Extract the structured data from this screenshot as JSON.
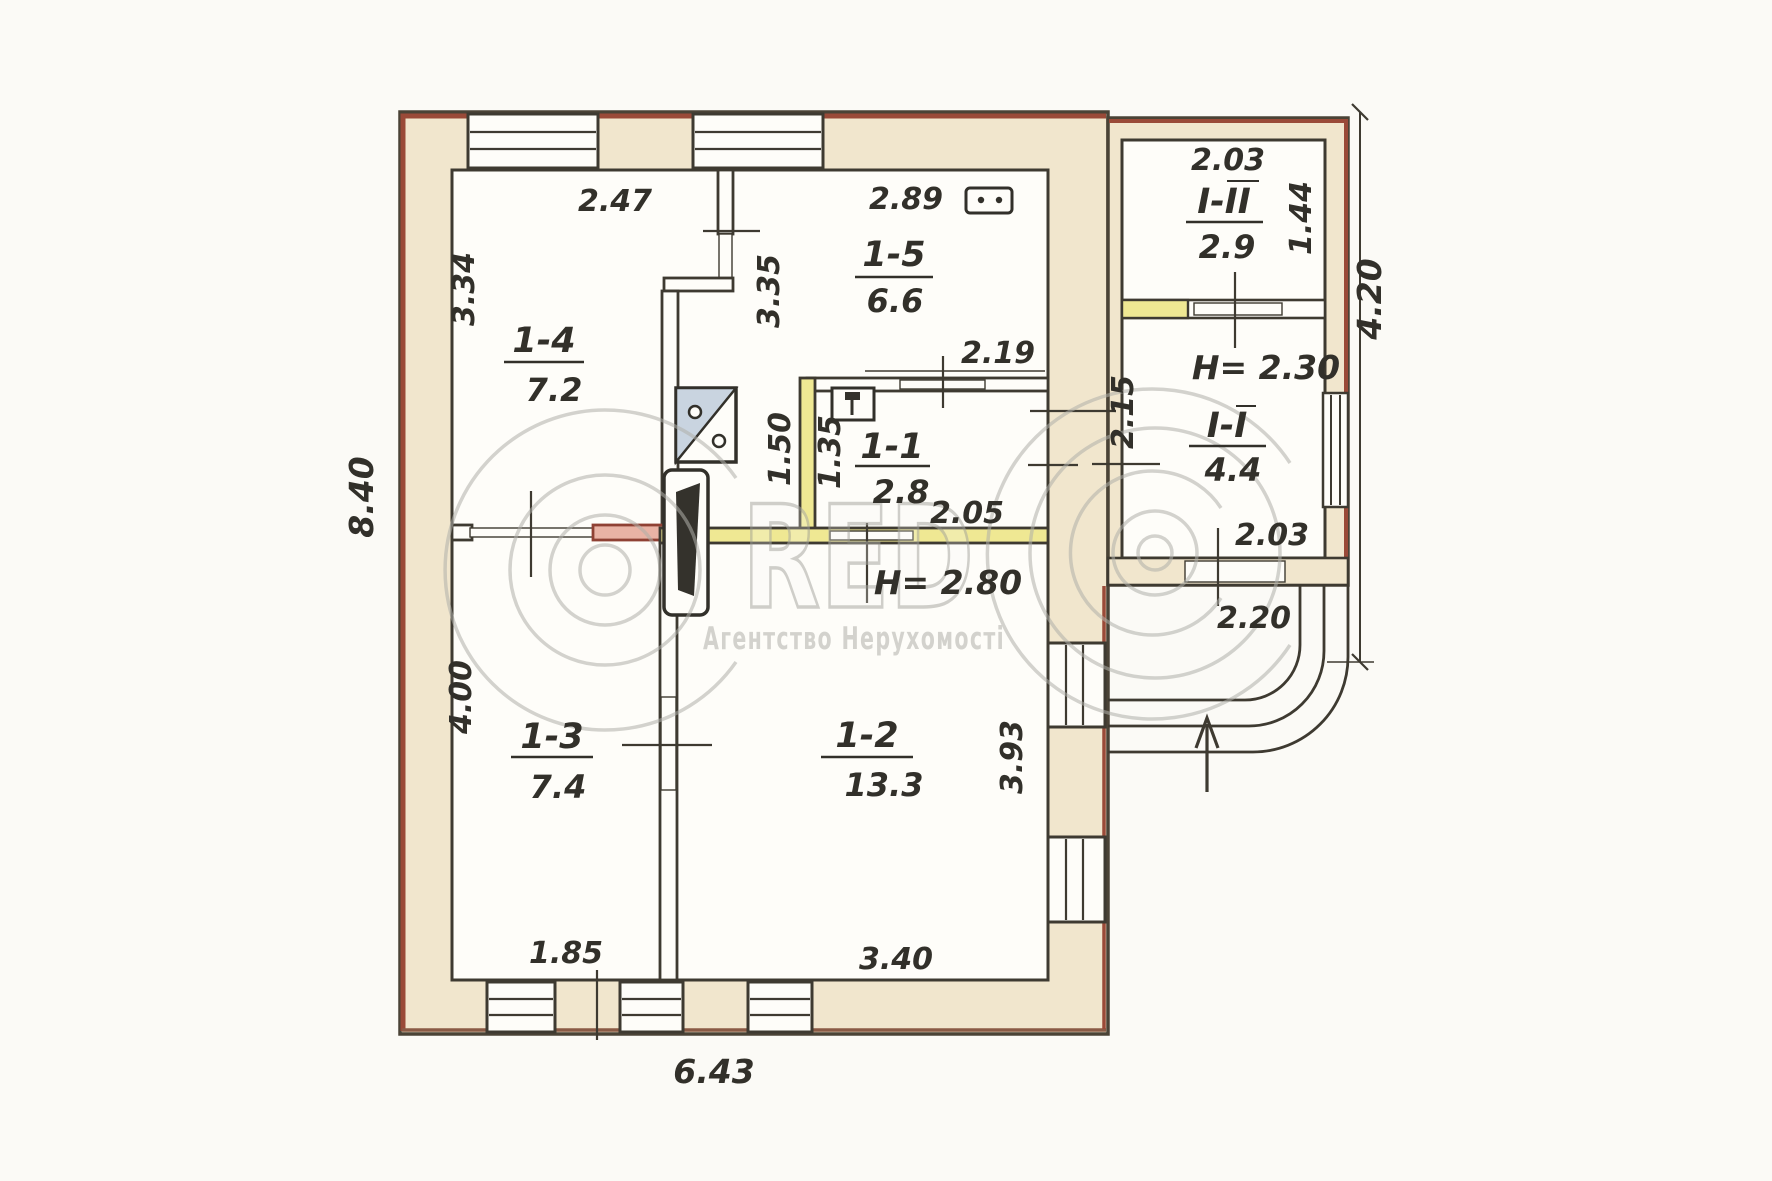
{
  "document": {
    "type": "floor-plan-scan"
  },
  "rooms": {
    "r14": {
      "id": "1-4",
      "area": "7.2"
    },
    "r15": {
      "id": "1-5",
      "area": "6.6"
    },
    "r11": {
      "id": "1-1",
      "area": "2.8"
    },
    "r13": {
      "id": "1-3",
      "area": "7.4"
    },
    "r12": {
      "id": "1-2",
      "area": "13.3"
    },
    "a2": {
      "id": "І-ІІ",
      "area": "2.9"
    },
    "a1": {
      "id": "І-І",
      "area": "4.4"
    }
  },
  "dims": {
    "outer_left": "8.40",
    "outer_bottom": "6.43",
    "annex_right_total": "4.20",
    "r14_top": "2.47",
    "r14_left": "3.34",
    "r15_top": "2.89",
    "hall_length": "3.35",
    "r11_top": "2.19",
    "r11_bottom": "2.05",
    "hall_width": "1.50",
    "r11_left": "1.35",
    "r13_left": "4.00",
    "r13_bottom": "1.85",
    "r12_bottom": "3.40",
    "r12_right": "3.93",
    "a2_top": "2.03",
    "a2_right": "1.44",
    "a1_left": "2.15",
    "a1_bottom": "2.03",
    "porch_bottom": "2.20",
    "height_main": "Н= 2.80",
    "height_annex": "Н= 2.30"
  },
  "watermark": {
    "red": "RED",
    "agency": "Агентство Нерухомості"
  },
  "icons": {
    "stove": "stove-icon",
    "heater": "heating-furnace-icon",
    "sink": "sink-icon",
    "burners": "two-burner-stove-icon",
    "entrance": "entrance-arrow-icon"
  },
  "colors": {
    "wall_outline": "#3e3a31",
    "wall_fill": "#f1e6cd",
    "accent_red": "#9a4a38",
    "partition_yellow": "#efe893",
    "partition_pink": "#e9b3a5",
    "watermark_grey": "#b0b0aa"
  }
}
